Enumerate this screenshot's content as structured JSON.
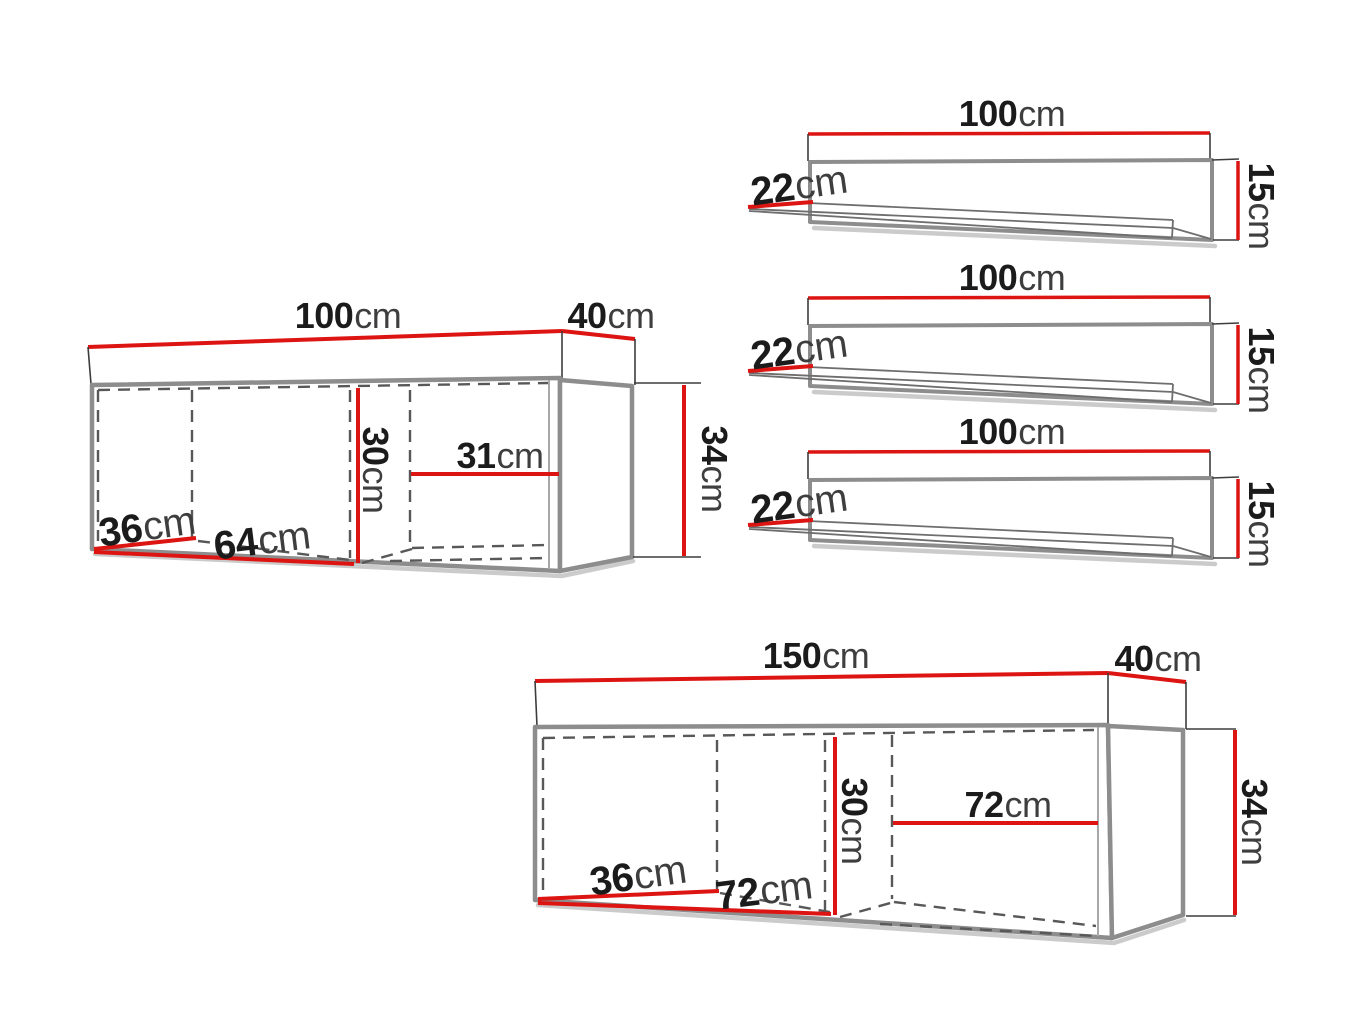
{
  "palette": {
    "dimension_red": "#dd1512",
    "outline_gray": "#8d8d8d",
    "dash_gray": "#585858",
    "number_black": "#1b1b1b",
    "unit_gray": "#3e3e3e",
    "background": "#ffffff"
  },
  "shelves": [
    {
      "width": {
        "value": "100",
        "unit": "cm"
      },
      "depth": {
        "value": "22",
        "unit": "cm"
      },
      "height": {
        "value": "15",
        "unit": "cm"
      }
    },
    {
      "width": {
        "value": "100",
        "unit": "cm"
      },
      "depth": {
        "value": "22",
        "unit": "cm"
      },
      "height": {
        "value": "15",
        "unit": "cm"
      }
    },
    {
      "width": {
        "value": "100",
        "unit": "cm"
      },
      "depth": {
        "value": "22",
        "unit": "cm"
      },
      "height": {
        "value": "15",
        "unit": "cm"
      }
    }
  ],
  "cabinets": [
    {
      "width": {
        "value": "100",
        "unit": "cm"
      },
      "depth": {
        "value": "40",
        "unit": "cm"
      },
      "height": {
        "value": "34",
        "unit": "cm"
      },
      "interior": {
        "inner_height": {
          "value": "30",
          "unit": "cm"
        },
        "right_compartment_width": {
          "value": "31",
          "unit": "cm"
        },
        "inner_depth": {
          "value": "36",
          "unit": "cm"
        },
        "left_compartment_width": {
          "value": "64",
          "unit": "cm"
        }
      }
    },
    {
      "width": {
        "value": "150",
        "unit": "cm"
      },
      "depth": {
        "value": "40",
        "unit": "cm"
      },
      "height": {
        "value": "34",
        "unit": "cm"
      },
      "interior": {
        "inner_height": {
          "value": "30",
          "unit": "cm"
        },
        "right_compartment_width": {
          "value": "72",
          "unit": "cm"
        },
        "inner_depth": {
          "value": "36",
          "unit": "cm"
        },
        "left_compartment_width": {
          "value": "72",
          "unit": "cm"
        }
      }
    }
  ]
}
